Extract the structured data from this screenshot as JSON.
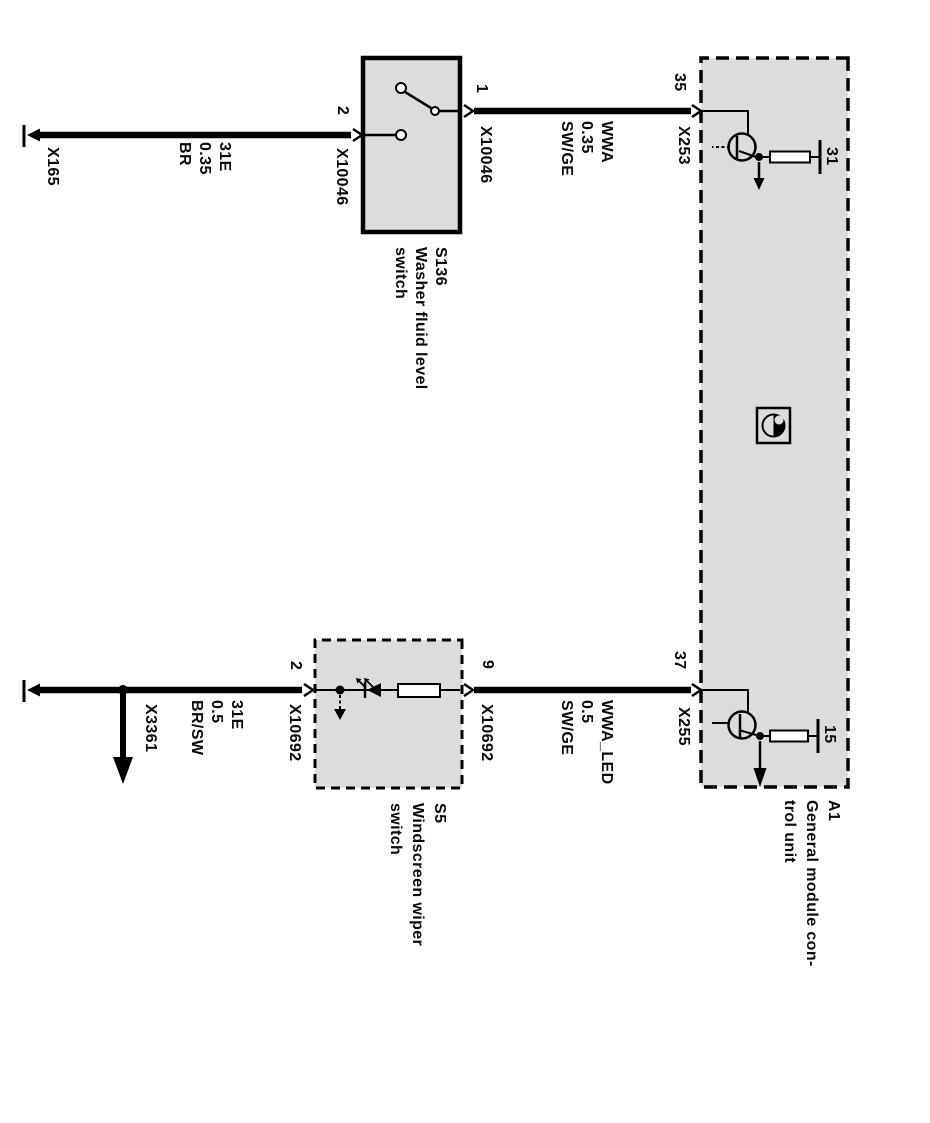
{
  "colors": {
    "background": "#ffffff",
    "box_fill": "#dcdcdc",
    "line": "#000000"
  },
  "modules": {
    "a1": {
      "ref": "A1",
      "name_line1": "General module con-",
      "name_line2": "trol unit",
      "pin35": "35",
      "pin37": "37",
      "pin31": "31",
      "pin15": "15",
      "conn35": "X253",
      "conn37": "X255"
    },
    "s136": {
      "ref": "S136",
      "name_line1": "Washer fluid level",
      "name_line2": "switch",
      "pin1": "1",
      "pin2": "2",
      "conn": "X10046"
    },
    "s5": {
      "ref": "S5",
      "name_line1": "Windscreen wiper",
      "name_line2": "switch",
      "pin9": "9",
      "pin2": "2",
      "conn": "X10692"
    }
  },
  "wires": {
    "w1": {
      "lines": [
        "31E",
        "0.35",
        "BR"
      ]
    },
    "w2": {
      "lines": [
        "WWA",
        "0.35",
        "SW/GE"
      ]
    },
    "w3": {
      "lines": [
        "31E",
        "0.5",
        "BR/SW"
      ]
    },
    "w4": {
      "lines": [
        "WWA_LED",
        "0.5",
        "SW/GE"
      ]
    }
  },
  "grounds": {
    "x165": "X165",
    "x3361": "X3361"
  }
}
